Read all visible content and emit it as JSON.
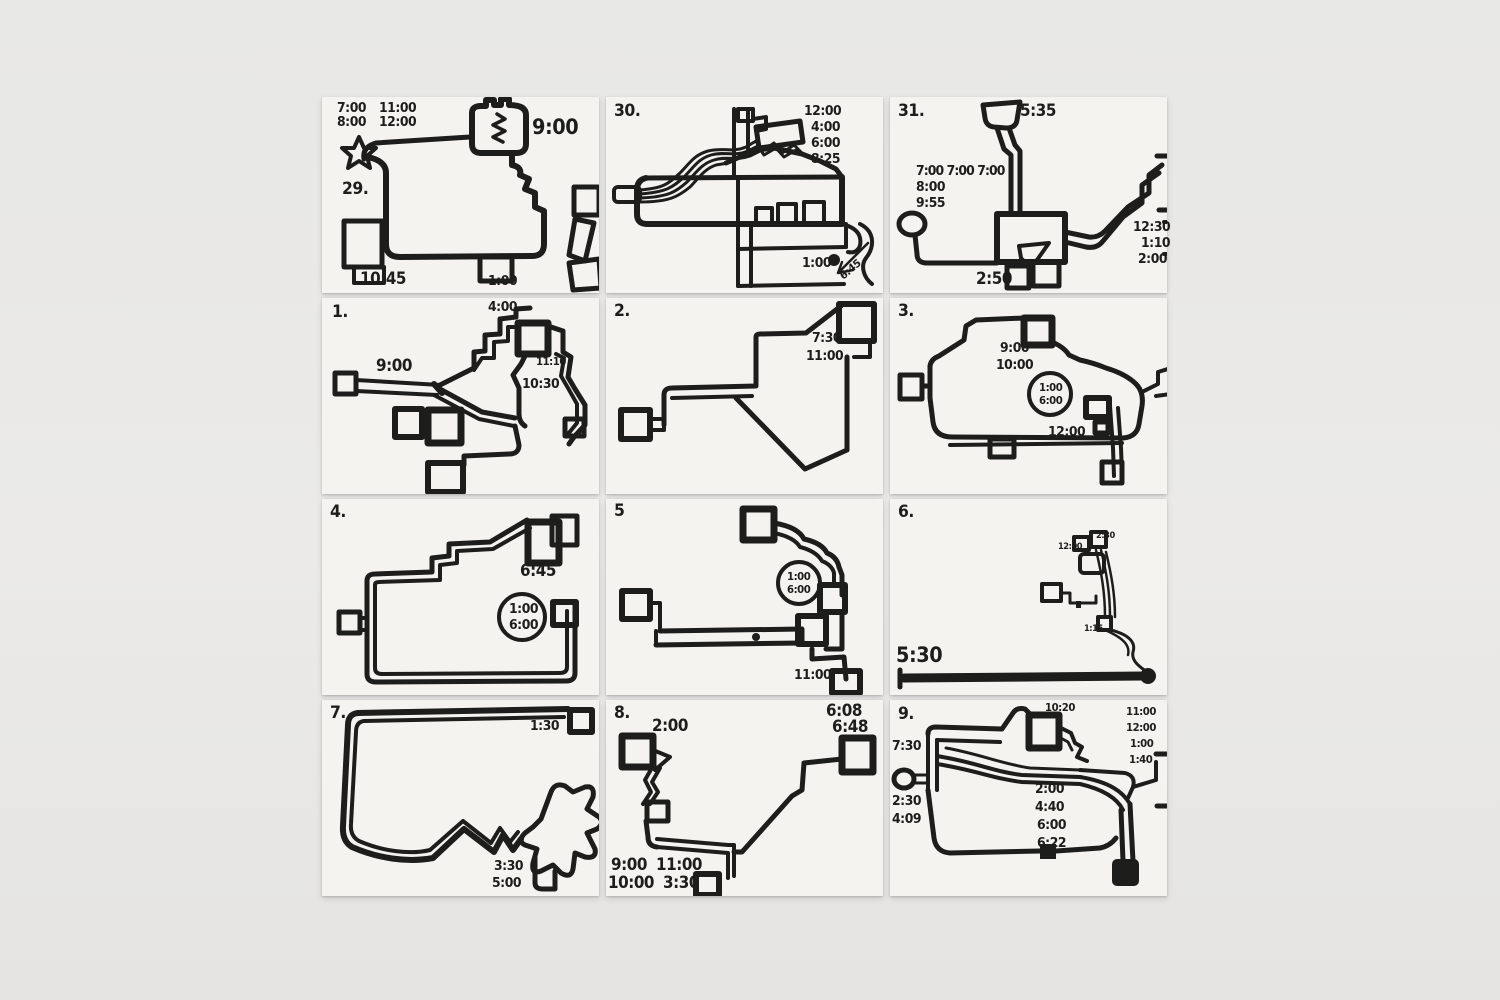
{
  "artwork": {
    "wall_color": "#e9e8e5",
    "paper_color": "#f4f3ef",
    "ink_color": "#1d1d1b"
  },
  "panels": [
    {
      "number": "29.",
      "times": [
        "7:00",
        "8:00",
        "11:00",
        "12:00",
        "9:00",
        "10:45",
        "1:00"
      ]
    },
    {
      "number": "30.",
      "times": [
        "12:00",
        "4:00",
        "6:00",
        "8:25",
        "1:00",
        "6:45"
      ]
    },
    {
      "number": "31.",
      "times": [
        "5:35",
        "7:00 7:00 7:00",
        "8:00",
        "9:55",
        "12:30",
        "1:10",
        "2:00",
        "2:50"
      ]
    },
    {
      "number": "1.",
      "times": [
        "4:00",
        "9:00",
        "11:10",
        "10:30"
      ]
    },
    {
      "number": "2.",
      "times": [
        "7:30",
        "11:00"
      ]
    },
    {
      "number": "3.",
      "times": [
        "9:00",
        "10:00",
        "1:00",
        "6:00",
        "12:00"
      ]
    },
    {
      "number": "4.",
      "times": [
        "6:45",
        "1:00",
        "6:00"
      ]
    },
    {
      "number": "5",
      "times": [
        "1:00",
        "6:00",
        "11:00"
      ]
    },
    {
      "number": "6.",
      "times": [
        "2:30",
        "12:00",
        "1:15",
        "5:30"
      ]
    },
    {
      "number": "7.",
      "times": [
        "1:30",
        "3:30",
        "5:00"
      ]
    },
    {
      "number": "8.",
      "times": [
        "2:00",
        "6:08",
        "6:48",
        "9:00",
        "10:00",
        "11:00",
        "3:30"
      ]
    },
    {
      "number": "9.",
      "times": [
        "10:20",
        "11:00",
        "12:00",
        "1:00",
        "1:40",
        "7:30",
        "2:30",
        "4:09",
        "2:00",
        "4:40",
        "6:00",
        "6:22"
      ]
    }
  ]
}
